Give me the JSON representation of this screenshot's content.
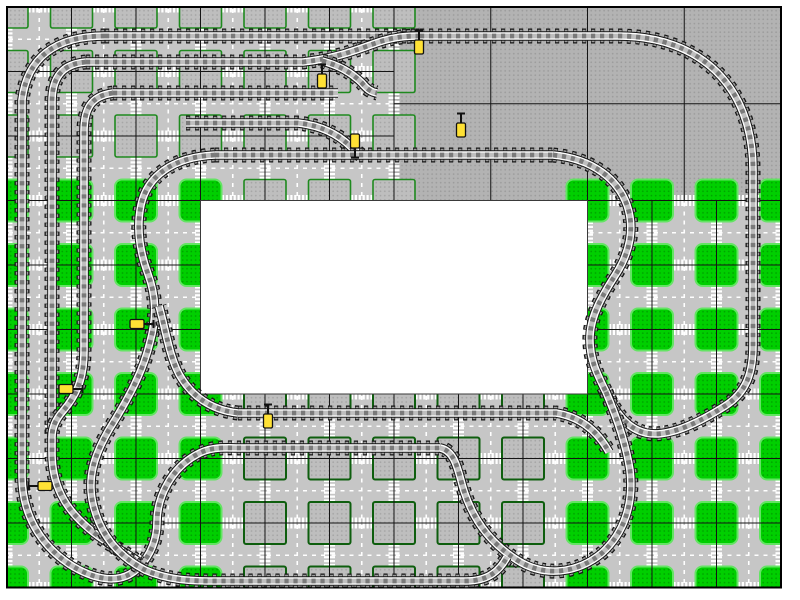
{
  "window": {
    "label": "train-track-layout-plan"
  },
  "canvas": {
    "x": 7,
    "y": 7,
    "cols": 12,
    "rows": 9,
    "cell": 64.5,
    "border_color": "#000000",
    "border_width": 2
  },
  "palette": {
    "page_bg": "#FFFFFF",
    "road": "#C6C6C6",
    "plain_bg": "#B3B3B3",
    "plain_dot": "#9C9C9C",
    "square_bg": "#BEBEBE",
    "square_dot": "#A5A5A5",
    "green_bg": "#00CF00",
    "green_dot": "#00A300",
    "green_border": "#63E463",
    "muted_border": "#1F8A1F",
    "dark_border": "#0E5E0E",
    "grid": "#141414",
    "marking": "#FFFFFF",
    "white_area_fill": "#FFFFFF",
    "white_area_border": "#3A3A3A",
    "signal_fill": "#FFE135",
    "signal_stroke": "#111111"
  },
  "regions": [
    {
      "name": "paved-plates-top-left",
      "type": "road-muted",
      "c0": 0,
      "r0": 0,
      "c1": 5,
      "r1": 2
    },
    {
      "name": "gray-baseplates-top-right",
      "type": "plain",
      "c0": 6,
      "r0": 0,
      "c1": 11,
      "r1": 2,
      "sub_cell": 96.75
    },
    {
      "name": "green-plates-mid-left",
      "type": "road-green",
      "c0": 0,
      "r0": 3,
      "c1": 2,
      "r1": 5
    },
    {
      "name": "white-reserved-area",
      "type": "blank",
      "c0": 3,
      "r0": 3,
      "c1": 8,
      "r1": 5
    },
    {
      "name": "green-plates-mid-right",
      "type": "road-green",
      "c0": 9,
      "r0": 3,
      "c1": 11,
      "r1": 5
    },
    {
      "name": "green-plates-bottom-left",
      "type": "road-green",
      "c0": 0,
      "r0": 6,
      "c1": 2,
      "r1": 8
    },
    {
      "name": "paved-plates-bottom-mid",
      "type": "road-dark",
      "c0": 3,
      "r0": 6,
      "c1": 8,
      "r1": 8
    },
    {
      "name": "green-plates-bottom-right",
      "type": "road-green",
      "c0": 9,
      "r0": 6,
      "c1": 11,
      "r1": 8
    }
  ],
  "decor": {
    "square_size": 42,
    "square_radius_green": 7,
    "square_radius_gray": 2,
    "crosswalk": {
      "bars": 6,
      "bar_w": 2.2,
      "bar_len": 11,
      "pitch": 3.9
    },
    "center_dash": {
      "on": 4,
      "off": 5,
      "w": 1.6
    }
  },
  "track_style": [
    {
      "color": "#151515",
      "w": 15,
      "dash": "4.2 4.8",
      "offset": 0
    },
    {
      "color": "#9C9C9C",
      "w": 12.4,
      "dash": "3 6",
      "offset": -0.6
    },
    {
      "color": "#151515",
      "w": 9.6,
      "dash": "",
      "offset": 0
    },
    {
      "color": "#FFFFFF",
      "w": 7.6,
      "dash": "",
      "offset": 0
    },
    {
      "color": "#BFBFBF",
      "w": 4.8,
      "dash": "",
      "offset": 0
    },
    {
      "color": "#7A7A7A",
      "w": 4.8,
      "dash": "4.2 4.8",
      "offset": 0
    }
  ],
  "tracks": [
    {
      "name": "outer-loop-top-right",
      "d": "M105,36 L618,36 C700,36 753,86 753,170 L753,345 C753,372 747,392 725,406 C700,422 668,438 646,433 C628,429 616,414 606,392"
    },
    {
      "name": "outer-loop-left",
      "d": "M105,36 C54,36 27,59 22,100 L22,476 C22,515 41,545 69,564 C94,580 120,585 137,569 C152,555 157,537 157,522 C157,497 171,469 196,455 C211,446 226,448 240,448 L440,448"
    },
    {
      "name": "inner-rect-right-s",
      "d": "M553,155 C594,159 618,180 627,205 C635,228 630,252 616,274 C602,296 591,315 590,336 C589,358 597,374 606,392"
    },
    {
      "name": "balloon-loop",
      "d": "M606,392 C617,418 626,444 630,470 C634,504 624,533 602,553 C578,573 545,578 517,560 C490,543 473,519 464,491 C458,472 456,451 440,448"
    },
    {
      "name": "x52-siding-loop",
      "d": "M86,62 C60,64 52,80 52,102 L52,453 C52,485 65,508 87,527 C105,543 124,551 140,563"
    },
    {
      "name": "y62-straight-merge",
      "d": "M86,62 L303,62 C339,58 361,48 379,42 C394,37 406,36 420,36"
    },
    {
      "name": "ladder-62-to-93",
      "d": "M322,61 C342,66 354,75 362,83 C367,89 371,92 377,93"
    },
    {
      "name": "x85-siding-loop",
      "d": "M113,93 C90,96 84,110 84,132 L84,351 C84,381 75,397 63,411 C55,420 52,428 52,437"
    },
    {
      "name": "y93-straight",
      "d": "M113,93 L338,93"
    },
    {
      "name": "y123-ladder",
      "d": "M186,123 L298,123 C325,126 341,137 351,147 C354,150 357,152 361,155"
    },
    {
      "name": "y155-straight",
      "d": "M215,155 L553,155"
    },
    {
      "name": "inner-west-loop",
      "d": "M215,155 C172,157 147,177 141,205 C136,229 140,252 148,274 C156,296 157,317 150,342 C143,372 128,399 110,428 C94,455 87,478 93,504 C100,534 118,556 145,570 C168,580 190,581 213,581 L466,581 C489,581 500,570 507,557"
    },
    {
      "name": "y413-straight",
      "d": "M238,413 L556,413 C581,417 598,432 609,452"
    },
    {
      "name": "y413-west-link",
      "d": "M238,413 C211,410 191,396 179,374 C169,355 166,331 159,306"
    }
  ],
  "signals": [
    {
      "x": 419,
      "y": 47,
      "rot": 0
    },
    {
      "x": 322,
      "y": 81,
      "rot": 0
    },
    {
      "x": 355,
      "y": 141,
      "rot": 180
    },
    {
      "x": 461,
      "y": 130,
      "rot": 0
    },
    {
      "x": 137,
      "y": 324,
      "rot": 90
    },
    {
      "x": 66,
      "y": 389,
      "rot": 90
    },
    {
      "x": 45,
      "y": 486,
      "rot": 270
    },
    {
      "x": 268,
      "y": 421,
      "rot": 0
    }
  ]
}
